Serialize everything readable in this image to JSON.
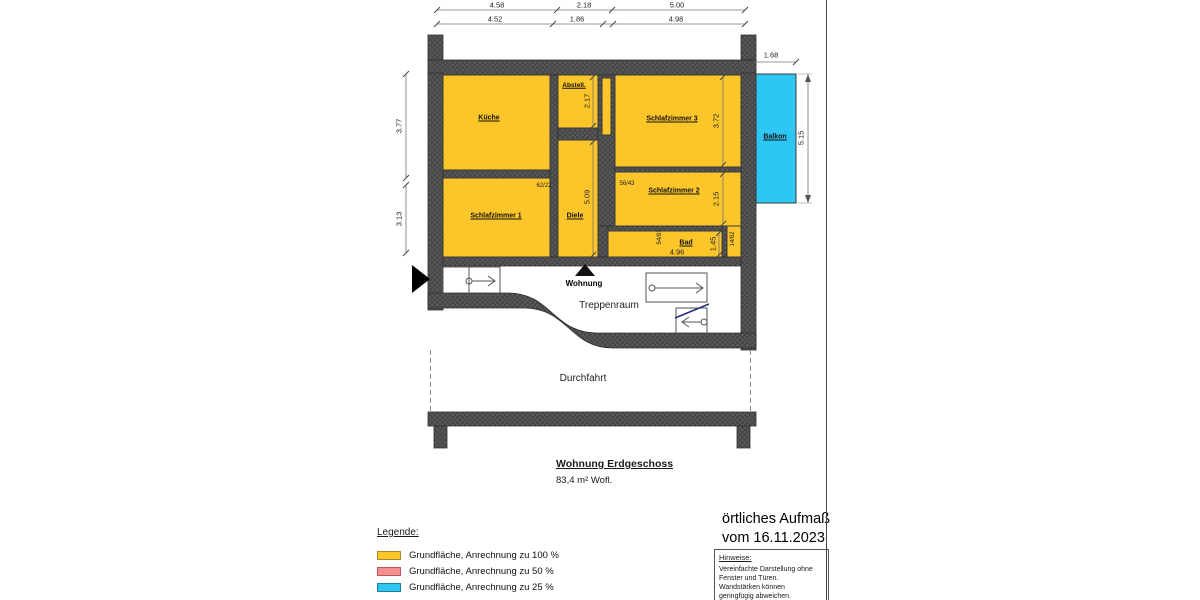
{
  "sheet": {
    "title": "Wohnung Erdgeschoss",
    "subtitle": "83,4 m² Wofl.",
    "survey_line1": "örtliches Aufmaß",
    "survey_line2": "vom 16.11.2023"
  },
  "rooms": {
    "kueche": "Küche",
    "abstell": "Abstell.",
    "schlafzimmer1": "Schlafzimmer 1",
    "schlafzimmer2": "Schlafzimmer 2",
    "schlafzimmer3": "Schlafzimmer 3",
    "diele": "Diele",
    "bad": "Bad",
    "balkon": "Balkon"
  },
  "areas": {
    "wohnung": "Wohnung",
    "treppenraum": "Treppenraum",
    "durchfahrt": "Durchfahrt"
  },
  "dimensions": {
    "top_row_outer": [
      "4.58",
      "2.18",
      "5.00"
    ],
    "top_row_inner": [
      "4.52",
      "1.86",
      "4.98"
    ],
    "left_upper": "3.77",
    "left_lower": "3.13",
    "balkon_width": "1.68",
    "balkon_height": "5.15",
    "abstell_depth": "2.17",
    "diele_length": "5.09",
    "schlafzimmer3_depth": "3.72",
    "schlafzimmer2_depth": "2.15",
    "bad_depth": "1.45",
    "bad_width": "4.96",
    "mark_sz1": "62/22",
    "mark_sz2": "56/43",
    "mark_bad": "54/81",
    "mark_bad_right": "14/62"
  },
  "legend": {
    "heading": "Legende:",
    "items": [
      {
        "label": "Grundfläche, Anrechnung zu 100 %",
        "color": "#fcc62b"
      },
      {
        "label": "Grundfläche, Anrechnung zu 50 %",
        "color": "#f2908f"
      },
      {
        "label": "Grundfläche, Anrechnung zu 25 %",
        "color": "#2ec6f2"
      }
    ]
  },
  "notes": {
    "heading": "Hinweise:",
    "body": "Vereinfachte Darstellung ohne Fenster und Türen. Wandstärken können geringfügig abweichen."
  },
  "colors": {
    "area_100": "#fcc62b",
    "area_25": "#2ec6f2",
    "wall": "#595959",
    "stair_cut_line": "#26327e"
  }
}
